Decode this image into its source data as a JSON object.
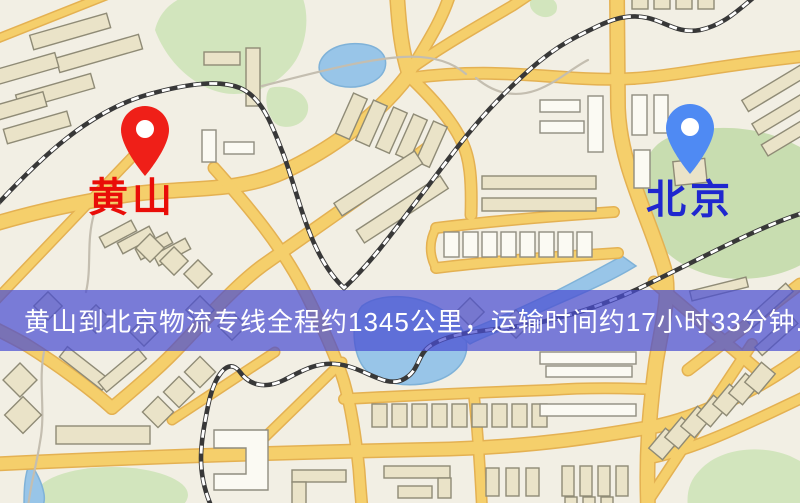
{
  "origin": {
    "name": "黄山",
    "pin_color": "#ef1f18",
    "label_color": "#e90d08"
  },
  "destination": {
    "name": "北京",
    "pin_color": "#4f8af3",
    "label_color": "#1f27cf"
  },
  "banner": {
    "text": "黄山到北京物流专线全程约1345公里，运输时间约17小时33分钟."
  },
  "route": {
    "distance_text": "约1345公里",
    "duration_text": "约17小时33分钟"
  },
  "palette": {
    "background": "#f2efe4",
    "road": "#f5cf6b",
    "road_casing": "#e4b152",
    "park": "#d2e5bd",
    "park_dark": "#c8ddb0",
    "water": "#98c5e8",
    "water_stroke": "#7fb2d8",
    "building_fill": "#eae3c8",
    "building_stroke": "#8f8b76",
    "railway": "#383838",
    "banner_overlay": "rgba(73,78,209,0.72)",
    "banner_text": "#ffffff",
    "origin_pin": "#ef1f18",
    "origin_label": "#e90d08",
    "destination_pin": "#4f8af3",
    "destination_label": "#1f27cf"
  }
}
